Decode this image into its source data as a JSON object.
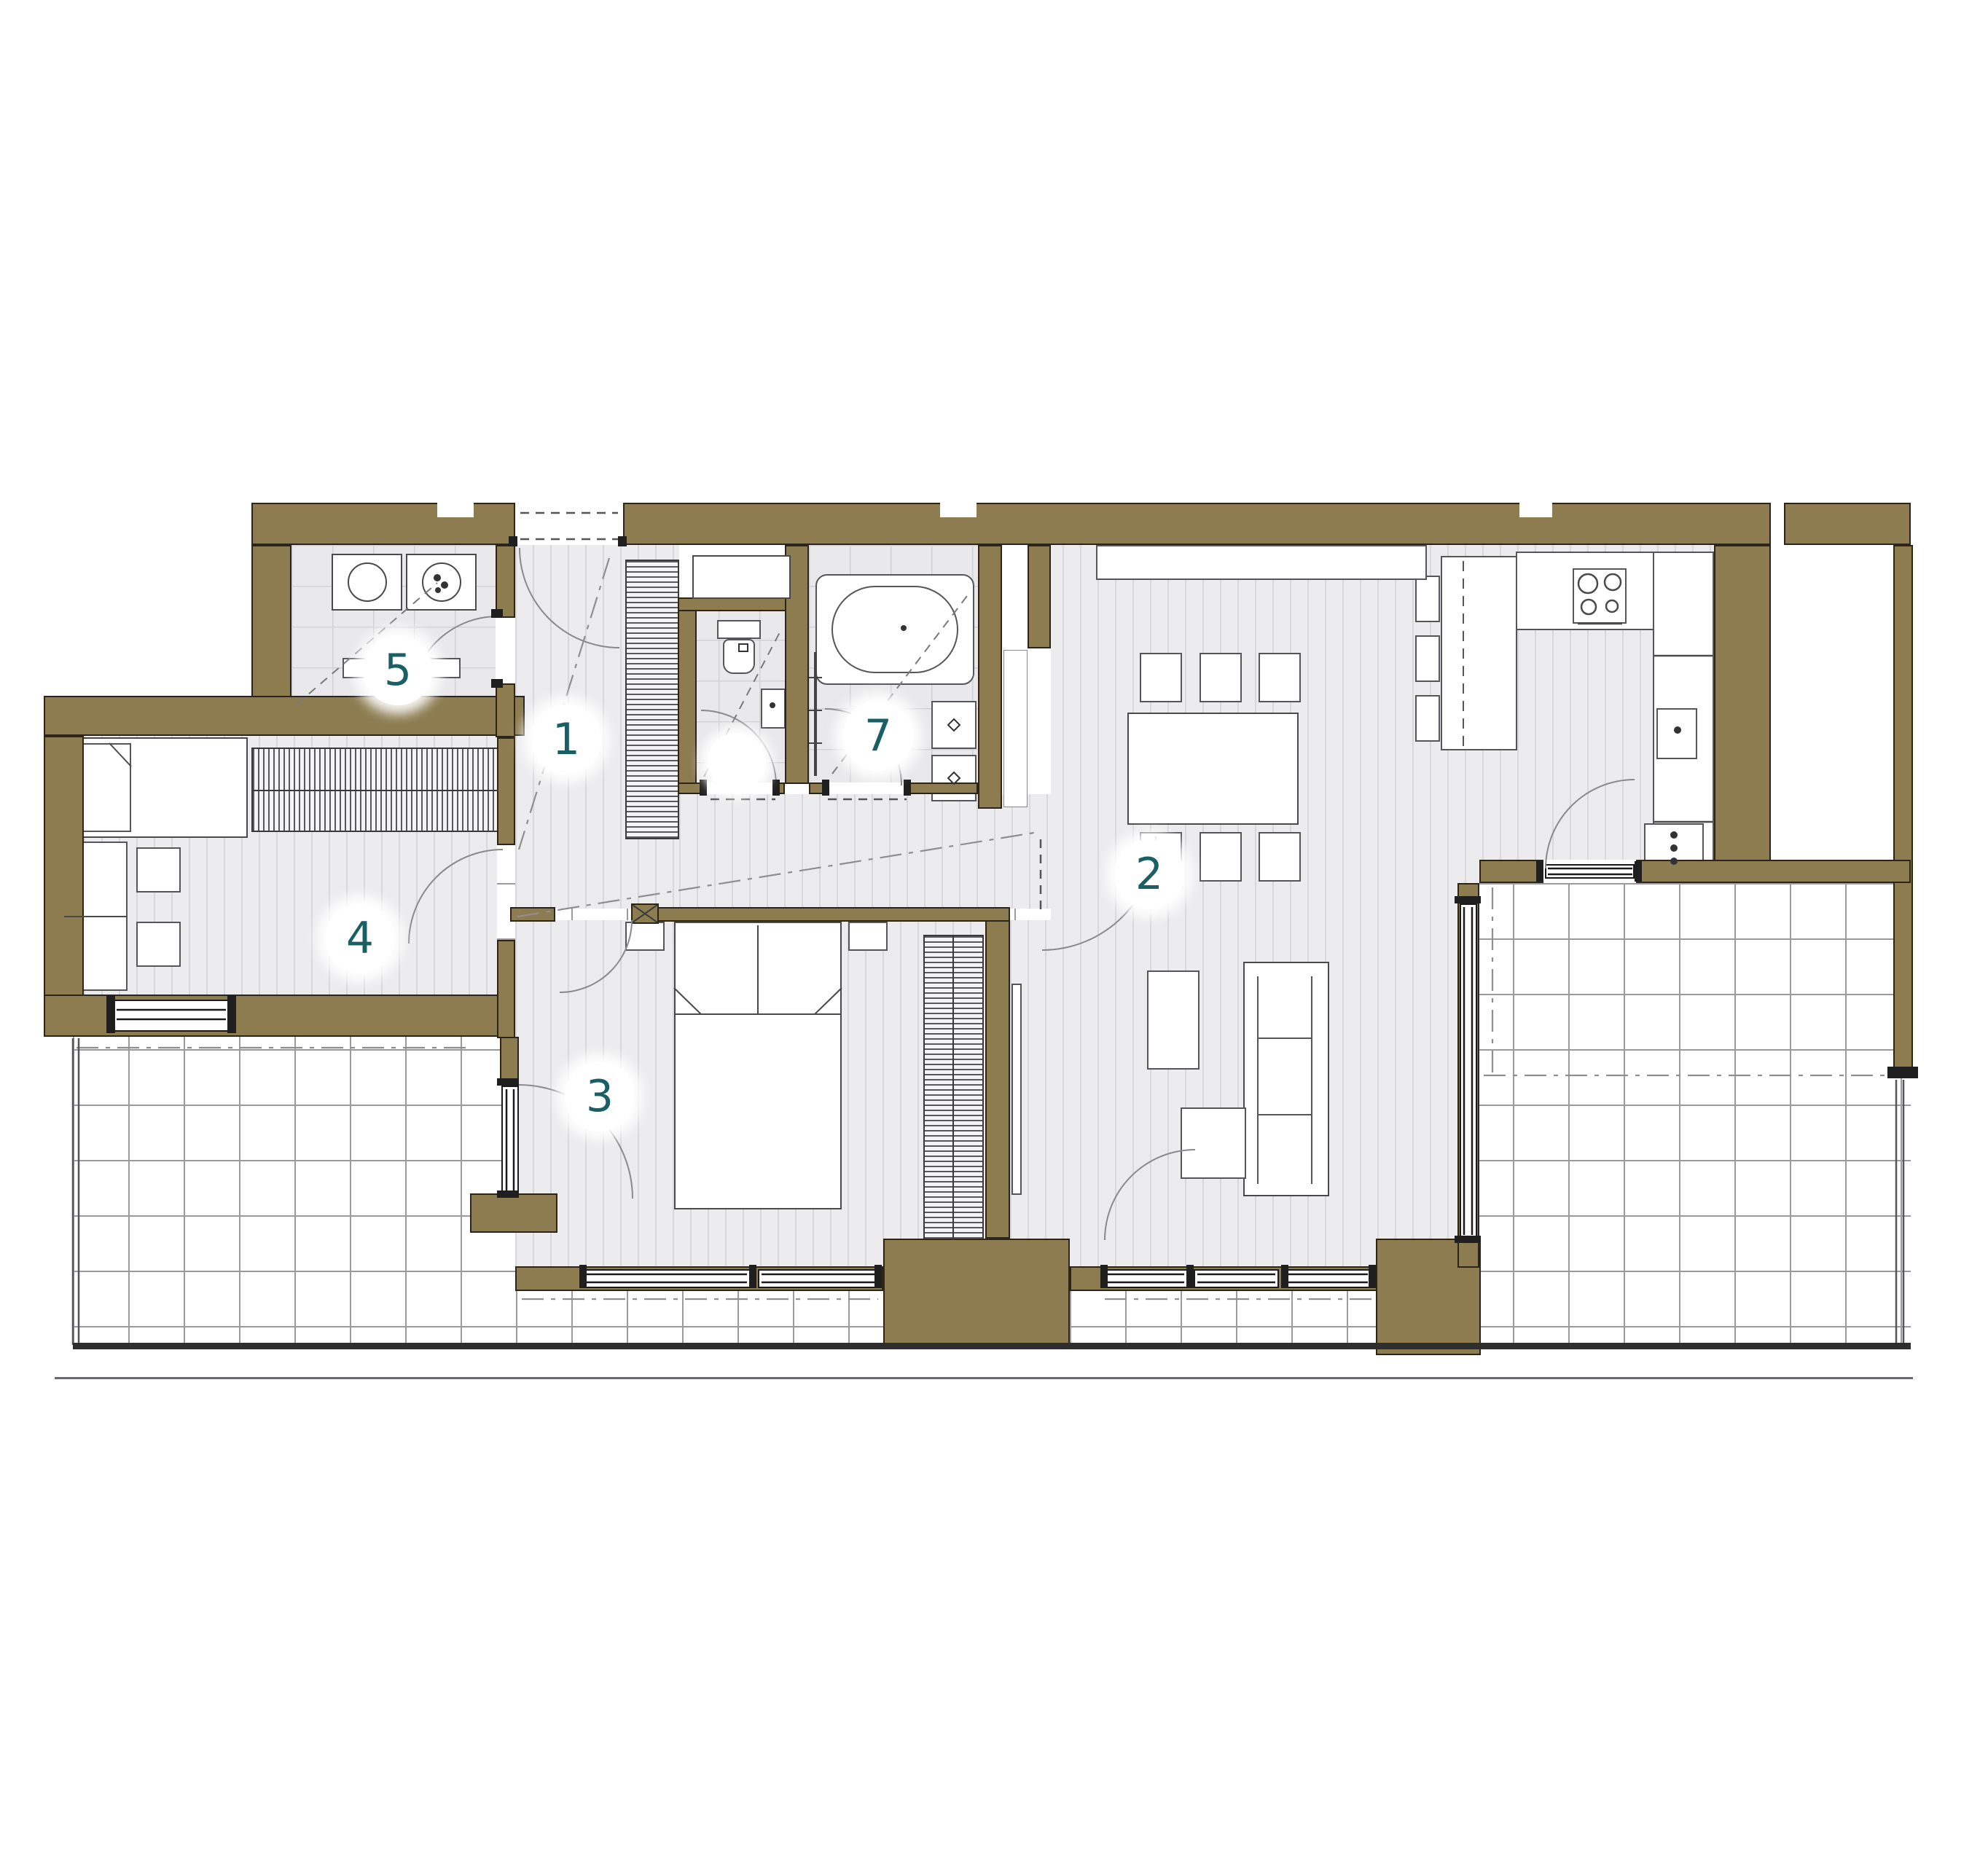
{
  "title": "apartment-floor-plan",
  "colors": {
    "wall": "#8c7c50",
    "wall_outline": "#2b2619",
    "label_text": "#1a5f63",
    "floor_wood": "#ececee",
    "floor_wood_stripe": "#d8d8dc",
    "floor_tile": "#e9e9eb",
    "tile_line": "#d2d2d6",
    "terrace_grid": "#9b9b9f",
    "furniture_outline": "#4a4a4a",
    "door_arc": "#8a8a8e"
  },
  "rooms": [
    {
      "id": "hallway",
      "label": "1"
    },
    {
      "id": "living-dining-kitchen",
      "label": "2"
    },
    {
      "id": "bedroom",
      "label": "3"
    },
    {
      "id": "room",
      "label": "4"
    },
    {
      "id": "utility-room",
      "label": "5"
    },
    {
      "id": "bathroom",
      "label": "7"
    },
    {
      "id": "wc",
      "label": ""
    }
  ],
  "fixtures": [
    "washing-machine",
    "dryer",
    "shelf",
    "toilet",
    "small-washbasin",
    "bathtub",
    "towel-radiator",
    "washbasin",
    "washbasin",
    "stove",
    "oven",
    "kitchen-counter",
    "kitchen-sink",
    "dishwasher",
    "kitchen-island",
    "bar-stool",
    "bar-stool",
    "bar-stool",
    "sideboard",
    "dining-table",
    "dining-chair",
    "dining-chair",
    "dining-chair",
    "dining-chair",
    "dining-chair",
    "dining-chair",
    "sofa",
    "coffee-table",
    "side-table",
    "tv-panel",
    "double-bed",
    "nightstand",
    "nightstand",
    "wardrobe-bedroom",
    "wardrobe-hallway",
    "wardrobe-room4",
    "single-bed",
    "desk",
    "chair",
    "chair"
  ]
}
